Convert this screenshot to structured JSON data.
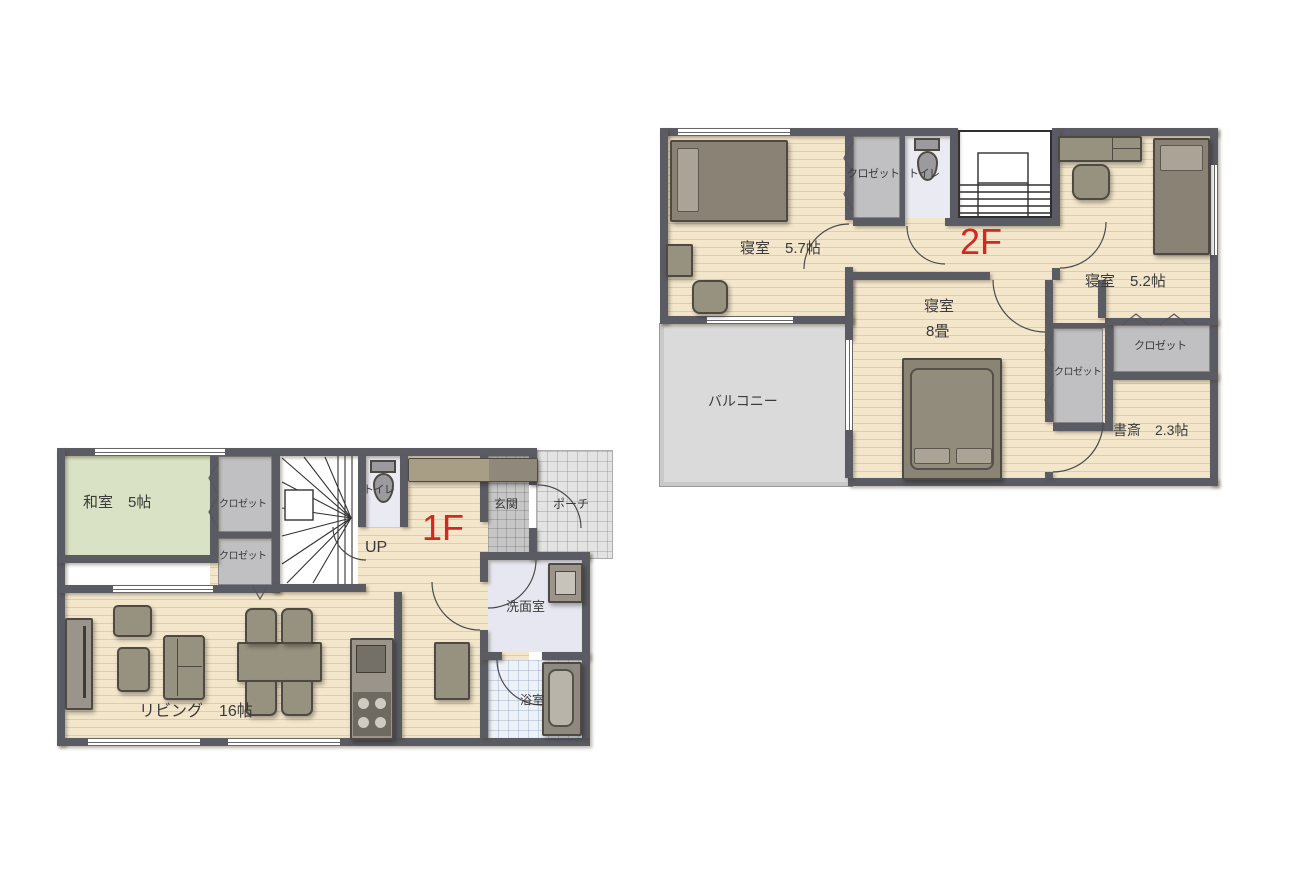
{
  "colors": {
    "wall": "#5B5B63",
    "floor_wood": "#F3E6CB",
    "tatami_green": "#D9E2C4",
    "closet_gray": "#C0C0C2",
    "balcony_gray": "#DADADA",
    "entrance_tile": "#C6C6C6",
    "porch_tile": "#E3E3E3",
    "wet_room": "#EAEAF3",
    "floor_label_red": "#D2281E"
  },
  "floor_1f": {
    "floor_label": "1F",
    "up_label": "UP",
    "rooms": {
      "washitsu": "和室　5帖",
      "closet_top": "クロゼット",
      "closet_bottom": "クロゼット",
      "toilet": "トイレ",
      "entrance": "玄関",
      "porch": "ポーチ",
      "washroom": "洗面室",
      "bathroom": "浴室",
      "living": "リビング　16帖"
    }
  },
  "floor_2f": {
    "floor_label": "2F",
    "rooms": {
      "bedroom_57": "寝室　5.7帖",
      "closet_top": "クロゼット",
      "toilet": "トイレ",
      "bedroom_52": "寝室　5.2帖",
      "bedroom_8_name": "寝室",
      "bedroom_8_size": "8畳",
      "balcony": "バルコニー",
      "closet_mid": "クロゼット",
      "closet_right": "クロゼット",
      "study": "書斎　2.3帖"
    }
  }
}
